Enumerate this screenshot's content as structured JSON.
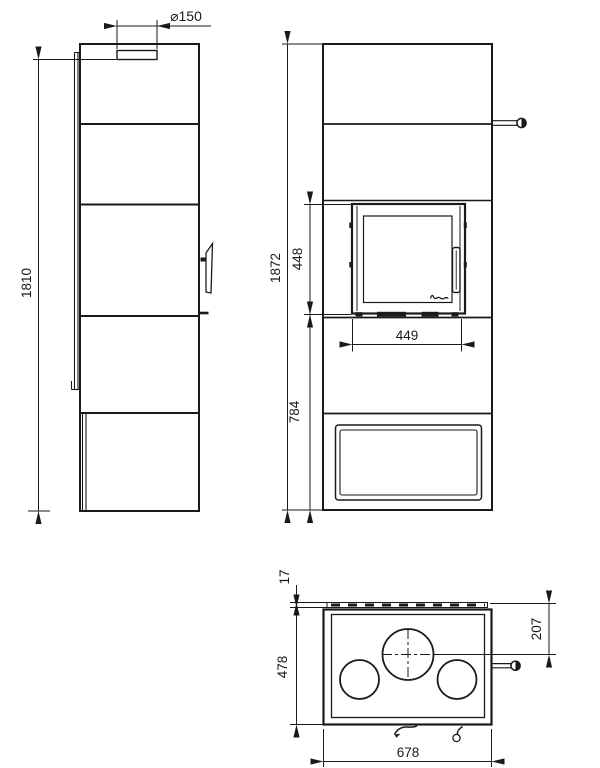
{
  "drawing": {
    "type": "technical-drawing-wood-stove",
    "background_color": "#ffffff",
    "line_color": "#1a1a1a",
    "logo_icon": "brand-script-logo",
    "views": {
      "side": "side-view",
      "front": "front-view",
      "top": "top-view"
    },
    "dims": {
      "flue_diameter": "⌀150",
      "side_height": "1810",
      "front_total_height": "1872",
      "window_height": "448",
      "window_width": "449",
      "lower_section_height": "784",
      "top_back_strip": "17",
      "depth": "478",
      "flue_offset_from_back": "207",
      "width": "678"
    }
  }
}
